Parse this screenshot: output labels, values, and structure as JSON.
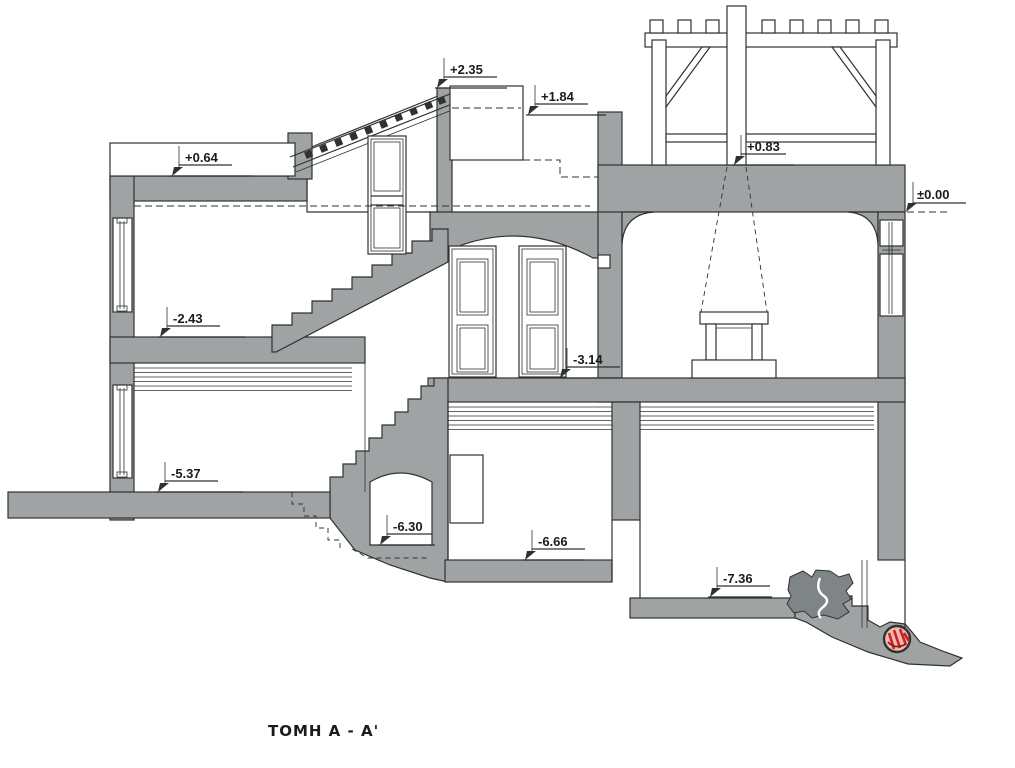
{
  "drawing": {
    "title": "ΤΟΜΗ Α - Α'"
  },
  "colors": {
    "poche": "#a0a3a4",
    "line": "#2f3133",
    "rock": "#7f8587",
    "red": "#c8251f",
    "red_fill": "#efb9b4",
    "paper": "#ffffff"
  },
  "levels": [
    {
      "name": "level-plus-2-35",
      "label": "+2.35"
    },
    {
      "name": "level-plus-1-84",
      "label": "+1.84"
    },
    {
      "name": "level-plus-0-64",
      "label": "+0.64"
    },
    {
      "name": "level-plus-0-83",
      "label": "+0.83"
    },
    {
      "name": "level-zero",
      "label": "±0.00"
    },
    {
      "name": "level-minus-2-43",
      "label": "-2.43"
    },
    {
      "name": "level-minus-3-14",
      "label": "-3.14"
    },
    {
      "name": "level-minus-5-37",
      "label": "-5.37"
    },
    {
      "name": "level-minus-6-30",
      "label": "-6.30"
    },
    {
      "name": "level-minus-6-66",
      "label": "-6.66"
    },
    {
      "name": "level-minus-7-36",
      "label": "-7.36"
    }
  ]
}
